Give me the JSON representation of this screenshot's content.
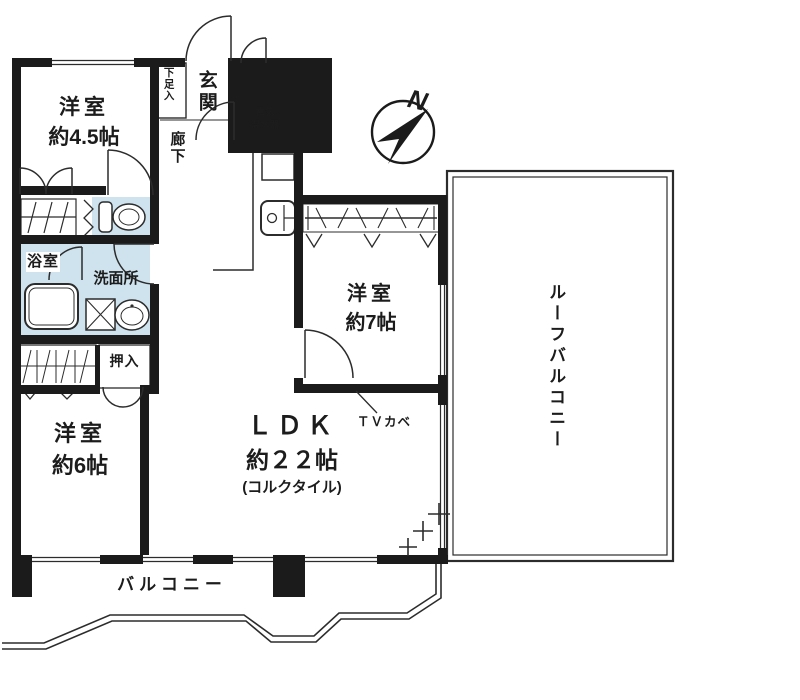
{
  "title": "マンション間取り図",
  "colors": {
    "wall": "#1b1b1b",
    "line": "#2c2c2c",
    "wet_area": "#cfe3ef",
    "background": "#ffffff"
  },
  "rooms": {
    "bedroom_small": {
      "name": "洋室",
      "area": "約4.5帖"
    },
    "bedroom_medium": {
      "name": "洋室",
      "area": "約6帖"
    },
    "bedroom_large": {
      "name": "洋室",
      "area": "約7帖"
    },
    "ldk": {
      "name": "ＬＤＫ",
      "area": "約２２帖",
      "finish": "(コルクタイル)"
    },
    "entrance": {
      "name": "玄関"
    },
    "shoe_cabinet": {
      "name": "下足入"
    },
    "hallway": {
      "name": "廊下"
    },
    "water_heater": {
      "name": "電気\n温水器"
    },
    "bathroom": {
      "name": "浴室"
    },
    "washroom": {
      "name": "洗面所"
    },
    "closet": {
      "name": "押入"
    },
    "balcony": {
      "name": "バルコニー"
    },
    "roof_balcony": {
      "name": "ルーフバルコニー"
    }
  },
  "annotations": {
    "tv_wall": "ＴＶカベ",
    "compass_north": "N"
  }
}
